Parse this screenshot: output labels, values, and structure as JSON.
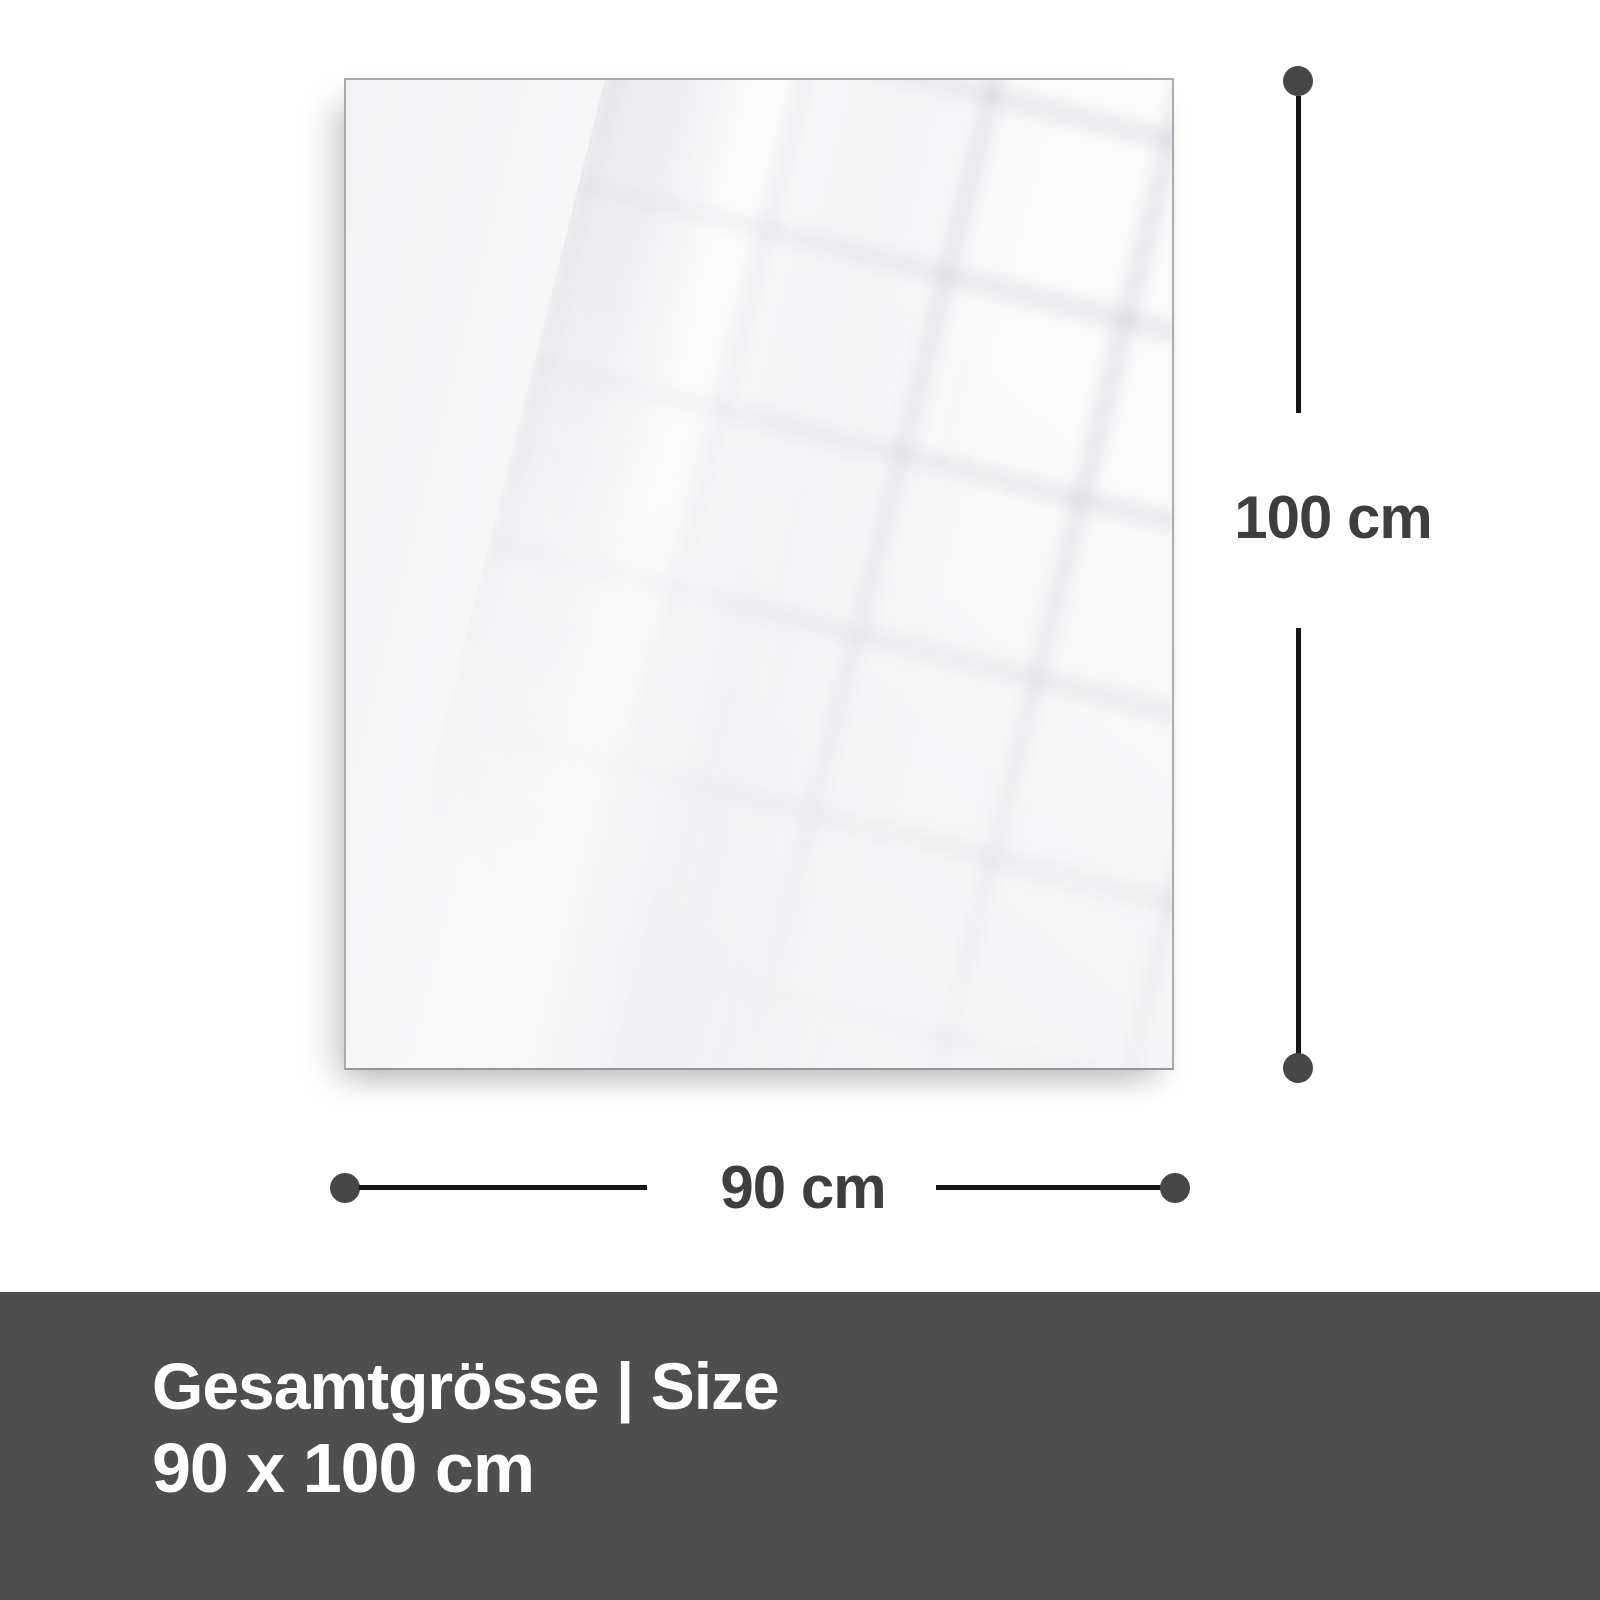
{
  "diagram": {
    "height_label": "100 cm",
    "width_label": "90 cm"
  },
  "footer": {
    "title": "Gesamtgrösse | Size",
    "size_value": "90 x 100 cm"
  },
  "colors": {
    "footer-bg": "#4e4e4e",
    "label-color": "#3e3e3e",
    "line-color": "#161616",
    "dot-color": "#474747",
    "panel-fill": "#f3f3f5",
    "panel-border": "#abaaae"
  }
}
